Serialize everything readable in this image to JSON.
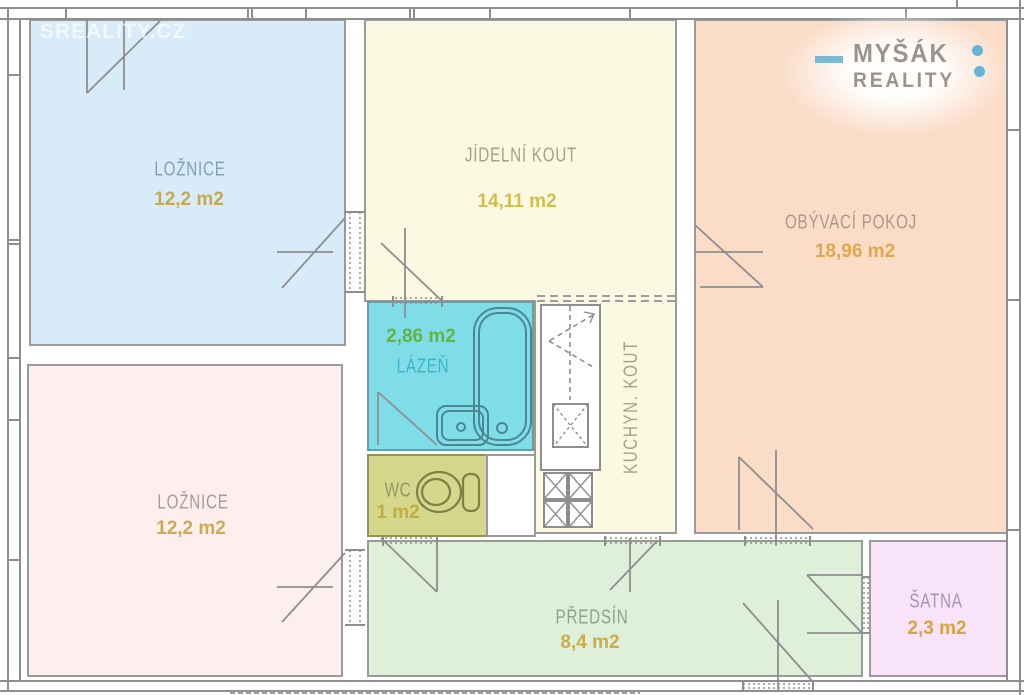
{
  "watermark": "SREALITY.CZ",
  "logo": {
    "word1": "MYŠÁK",
    "word2": "REALITY"
  },
  "rooms": {
    "bedroom_top": {
      "name": "LOŽNICE",
      "area": "12,2 m2"
    },
    "bedroom_bottom": {
      "name": "LOŽNICE",
      "area": "12,2 m2"
    },
    "dining": {
      "name": "JÍDELNÍ KOUT",
      "area": "14,11 m2"
    },
    "living": {
      "name": "OBÝVACÍ POKOJ",
      "area": "18,96 m2"
    },
    "bathroom": {
      "name": "LÁZEŇ",
      "area": "2,86 m2"
    },
    "wc": {
      "name": "WC",
      "area": "1 m2"
    },
    "kitchen": {
      "name": "KUCHYN. KOUT"
    },
    "hallway": {
      "name": "PŘEDSÍN",
      "area": "8,4 m2"
    },
    "closet": {
      "name": "ŠATNA",
      "area": "2,3 m2"
    }
  },
  "colors": {
    "bedroom_top_fill": "#d7ecf8",
    "bedroom_bottom_fill": "#fdefee",
    "dining_fill": "#fbf9e2",
    "living_fill": "#fadcc7",
    "bathroom_fill": "#7fdde8",
    "wc_fill": "#d5d88c",
    "hallway_fill": "#def0d9",
    "closet_fill": "#f8e3f8",
    "wall_gray": "#8e8e8e",
    "accent_blue": "#66b5d9",
    "logo_text": "#9c948c"
  }
}
